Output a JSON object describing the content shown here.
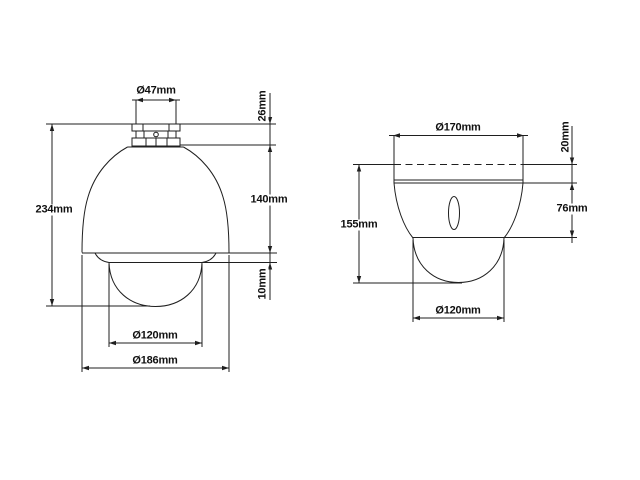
{
  "drawing": {
    "line_color": "#1f1f1f",
    "background_color": "#ffffff",
    "left_view": {
      "labels": {
        "top_diameter": "Ø47mm",
        "mount_height": "26mm",
        "total_height": "234mm",
        "body_height": "140mm",
        "rim_height": "10mm",
        "dome_diameter": "Ø120mm",
        "base_diameter": "Ø186mm"
      }
    },
    "right_view": {
      "labels": {
        "top_diameter": "Ø170mm",
        "cap_height": "20mm",
        "total_height": "155mm",
        "body_height": "76mm",
        "dome_diameter": "Ø120mm"
      }
    }
  }
}
